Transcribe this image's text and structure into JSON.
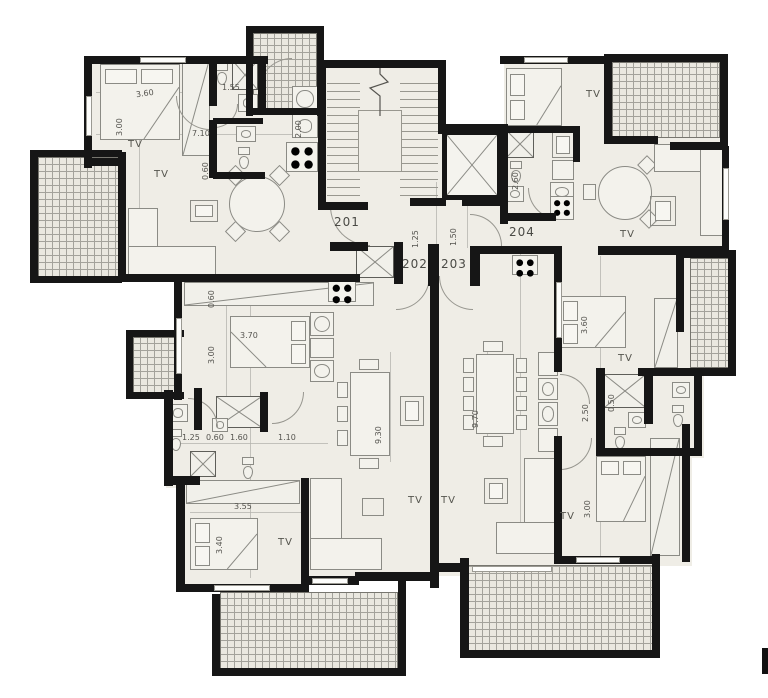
{
  "labels": {
    "tv": "TV"
  },
  "units": [
    {
      "number": "201"
    },
    {
      "number": "202"
    },
    {
      "number": "203"
    },
    {
      "number": "204"
    }
  ],
  "dims": [
    "3.60",
    "3.00",
    "7.10",
    "1.55",
    "0.60",
    "2.00",
    "1.25",
    "1.50",
    "2.60",
    "0.60",
    "3.00",
    "3.70",
    "9.30",
    "9.70",
    "1.25",
    "0.60",
    "1.60",
    "1.10",
    "3.55",
    "3.40",
    "3.60",
    "2.50",
    "0.50",
    "3.00"
  ],
  "colors": {
    "wall": "#161616",
    "floor": "#efede6",
    "balcony_fill": "#eae8e0",
    "hatch_line": "#a3a29b",
    "furniture_line": "#8b8b85",
    "dim_text": "#55544f",
    "label_text": "#4a4a45"
  }
}
